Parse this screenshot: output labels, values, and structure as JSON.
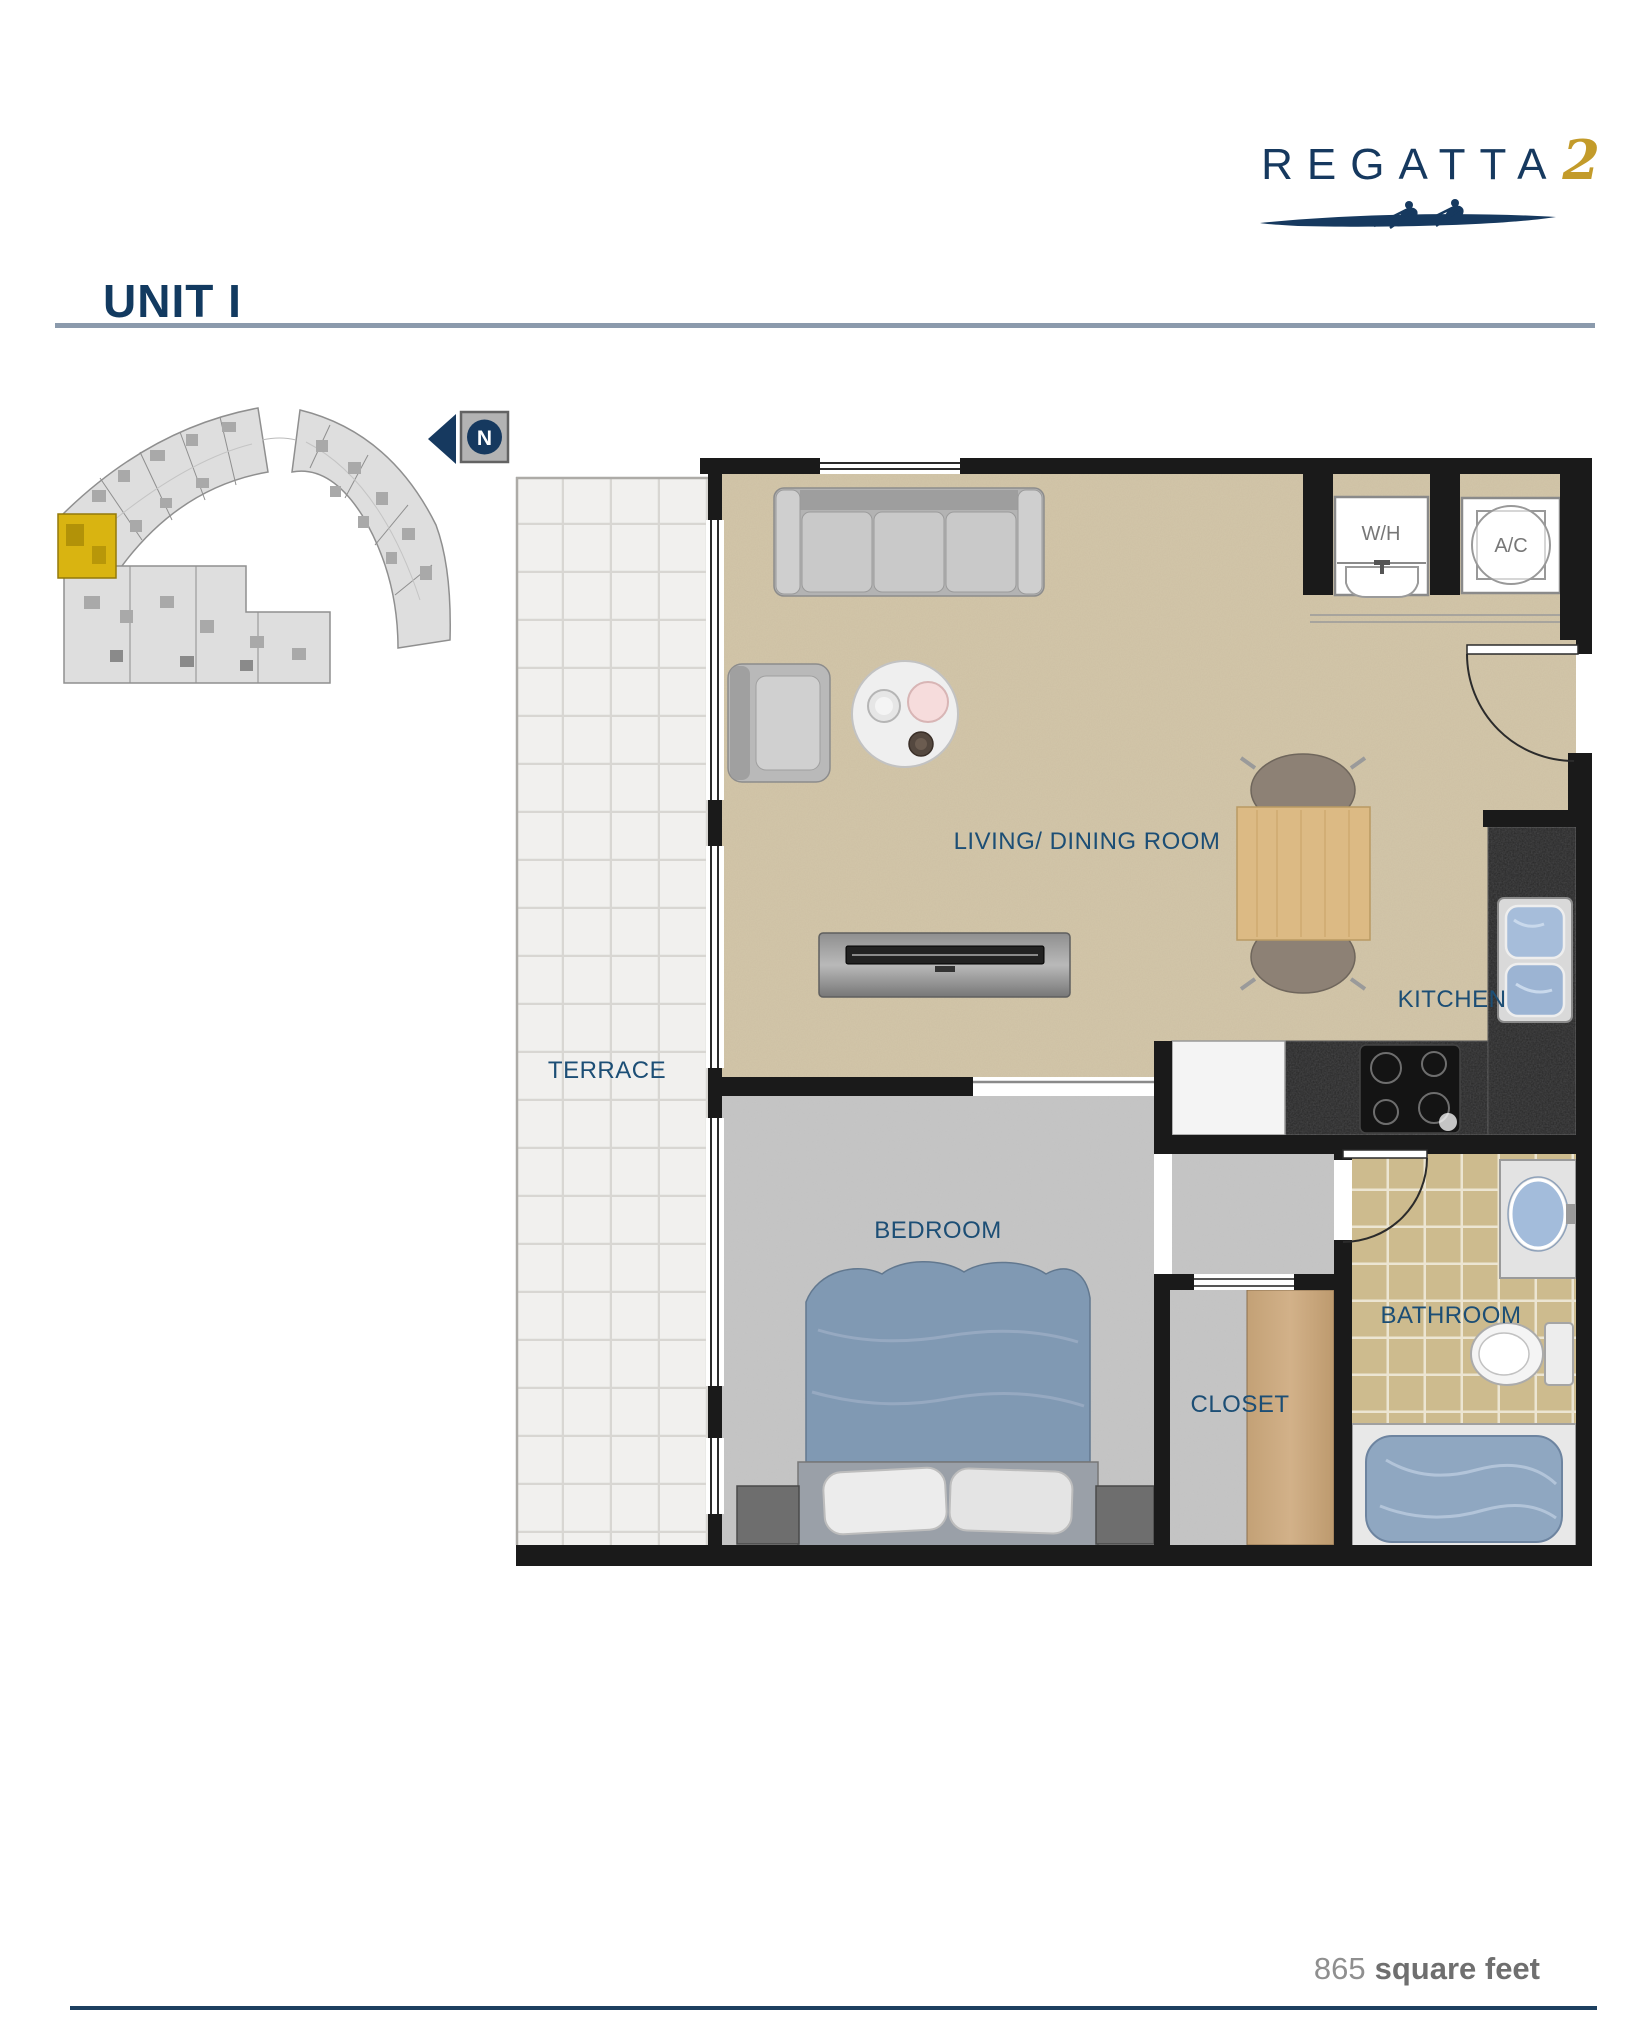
{
  "brand": {
    "name": "REGATTA",
    "number": "2",
    "navy": "#16395f",
    "gold": "#c39b2a"
  },
  "heading": {
    "title": "UNIT I"
  },
  "north": {
    "label": "N"
  },
  "key_plan": {
    "highlight_color": "#d9b411"
  },
  "rooms": {
    "terrace": "TERRACE",
    "living_dining": "LIVING/ DINING ROOM",
    "kitchen": "KITCHEN",
    "bedroom": "BEDROOM",
    "closet": "CLOSET",
    "bathroom": "BATHROOM",
    "water_heater": "W/H",
    "air_conditioning": "A/C"
  },
  "footer": {
    "area_value": "865",
    "area_unit": "square feet"
  },
  "colors": {
    "label_blue": "#1c4e75",
    "wall_black": "#1a1a1a",
    "carpet_beige": "#d4c7aa",
    "carpet_gray": "#c6c6c6",
    "bath_tile": "#cdbb8e"
  }
}
